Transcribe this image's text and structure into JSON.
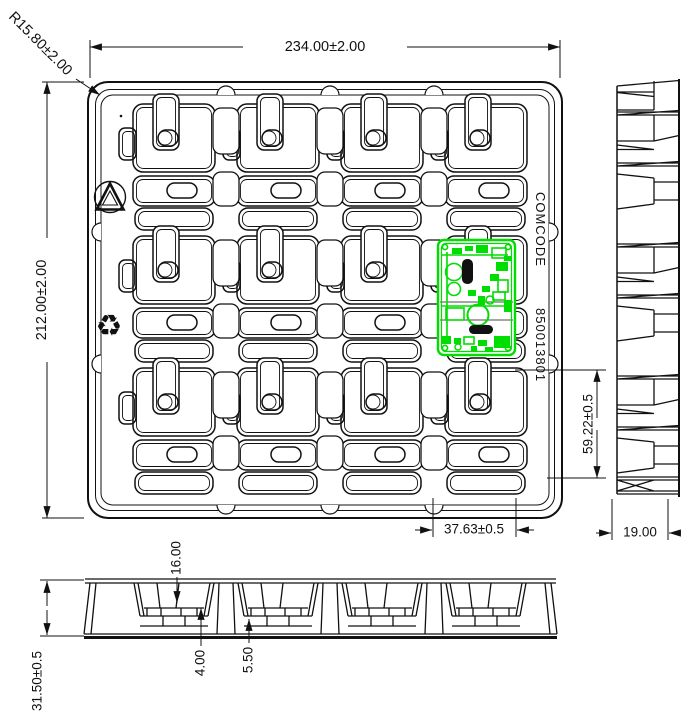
{
  "drawing": {
    "title": "Tray engineering drawing with PCB in pocket",
    "top_view": {
      "overall_width": "234.00±2.00",
      "overall_height": "212.00±2.00",
      "corner_radius": "R15.80±2.00",
      "pcb_offset_horizontal": "37.63±0.5",
      "pcb_offset_vertical": "59.22±0.5",
      "marking_label": "COMCODE",
      "marking_number": "850013801",
      "grid_rows": 3,
      "grid_columns": 4,
      "pcb_position": {
        "row": 2,
        "column": 4
      }
    },
    "side_view": {
      "base_width": "19.00"
    },
    "front_view": {
      "overall_height": "31.50±0.5",
      "pocket_depth": "16.00",
      "rib_dim_1": "4.00",
      "rib_dim_2": "5.50"
    },
    "icons": {
      "recycle_triangle": "recycle-triangle-icon",
      "mobius_loop": "♻"
    },
    "colors": {
      "line": "#111111",
      "pcb_green": "#00dd00",
      "background": "#ffffff"
    }
  }
}
